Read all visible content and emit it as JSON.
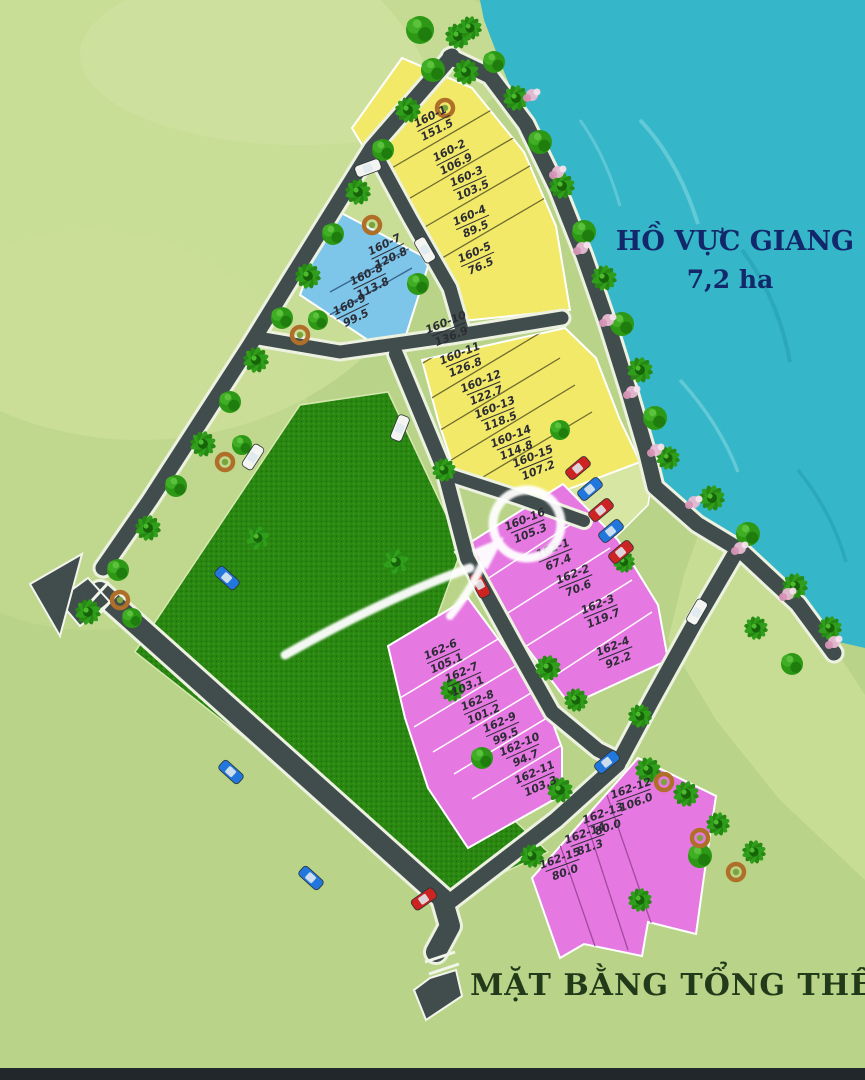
{
  "title": "MẶT BẰNG TỔNG THỂ",
  "lake": {
    "name": "HỒ VỰC GIANG",
    "area_label": "7,2 ha"
  },
  "legend": {
    "yellow_block": "#f2e968",
    "blue_block": "#7ec5ea",
    "pink_block": "#e678e2",
    "park_green": "#2a8711",
    "road": "#414d4d",
    "water": "#35b6c9"
  },
  "plots": {
    "yellow_upper": [
      {
        "id": "160-1",
        "area": "151.5"
      },
      {
        "id": "160-2",
        "area": "106.9"
      },
      {
        "id": "160-3",
        "area": "103.5"
      },
      {
        "id": "160-4",
        "area": "89.5"
      },
      {
        "id": "160-5",
        "area": "76.5"
      }
    ],
    "blue": [
      {
        "id": "160-7",
        "area": "120.8"
      },
      {
        "id": "160-8",
        "area": "113.8"
      },
      {
        "id": "160-9",
        "area": "99.5"
      }
    ],
    "yellow_lower": [
      {
        "id": "160-10",
        "area": "136.9"
      },
      {
        "id": "160-11",
        "area": "126.8"
      },
      {
        "id": "160-12",
        "area": "122.7"
      },
      {
        "id": "160-13",
        "area": "118.5"
      },
      {
        "id": "160-14",
        "area": "114.8"
      },
      {
        "id": "160-15",
        "area": "107.2"
      }
    ],
    "pink_upper": [
      {
        "id": "160-16",
        "area": "105.3",
        "highlighted": true
      },
      {
        "id": "162-1",
        "area": "67.4"
      },
      {
        "id": "162-2",
        "area": "70.6"
      },
      {
        "id": "162-3",
        "area": "119.7"
      },
      {
        "id": "162-4",
        "area": "92.2"
      }
    ],
    "pink_mid": [
      {
        "id": "162-6",
        "area": "105.1"
      },
      {
        "id": "162-7",
        "area": "103.1"
      },
      {
        "id": "162-8",
        "area": "101.2"
      },
      {
        "id": "162-9",
        "area": "99.5"
      },
      {
        "id": "162-10",
        "area": "94.7"
      },
      {
        "id": "162-11",
        "area": "103.3"
      }
    ],
    "pink_lower": [
      {
        "id": "162-12",
        "area": "106.0"
      },
      {
        "id": "162-13",
        "area": "80.0"
      },
      {
        "id": "162-14",
        "area": "81.3"
      },
      {
        "id": "162-15",
        "area": "80.0"
      }
    ]
  }
}
